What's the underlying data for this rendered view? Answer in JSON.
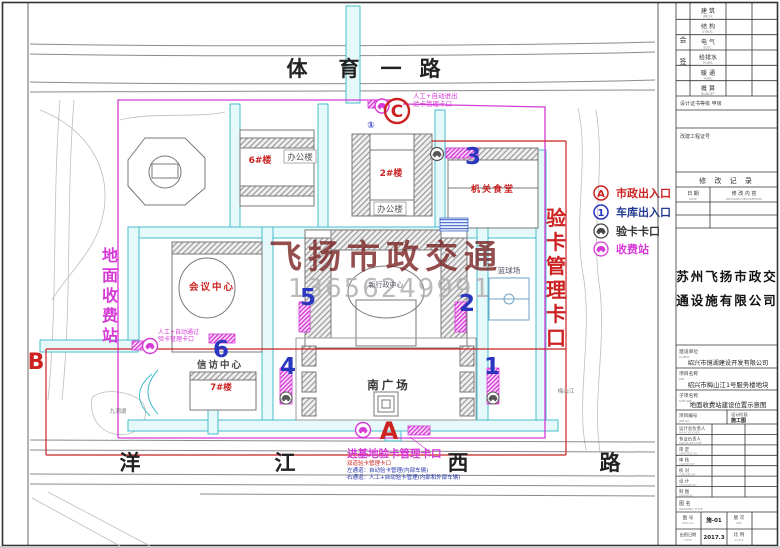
{
  "palette": {
    "red": "#cc2222",
    "blue": "#2a35c0",
    "magenta": "#d63ad6",
    "cyan": "#45bccc",
    "ink": "#333333"
  },
  "roads": {
    "top": [
      "体",
      "育",
      "一",
      "路"
    ],
    "bottom": [
      "洋",
      "江",
      "西",
      "路"
    ]
  },
  "legend": {
    "items": [
      {
        "symbol": "A",
        "label": "市政出入口",
        "color": "#cc2222"
      },
      {
        "symbol": "1",
        "label": "车库出入口",
        "color": "#223a8f"
      },
      {
        "symbol": "car-icon",
        "label": "验卡卡口",
        "color": "#333333"
      },
      {
        "symbol": "car-icon",
        "label": "收费站",
        "color": "#d63ad6"
      }
    ]
  },
  "markers": {
    "a": "A",
    "b": "B",
    "c": "C",
    "c_sub": "①",
    "garage": [
      "1",
      "2",
      "3",
      "4",
      "5",
      "6"
    ]
  },
  "vlabels": {
    "right": [
      "验",
      "卡",
      "管",
      "理",
      "卡",
      "口"
    ],
    "left": [
      "地",
      "面",
      "收",
      "费",
      "站"
    ]
  },
  "gates": {
    "north": {
      "line1": "人工+自动进出",
      "line2": "验卡管理卡口"
    },
    "west": {
      "line1": "人工+自动通过",
      "line2": "验卡管理卡口"
    },
    "south": {
      "title": "进基地验卡管理卡口",
      "sub1": "双道验卡管理卡口",
      "sub2": "左通道：自动验卡管理(内部车辆)",
      "sub3": "右通道：人工+自动验卡管理(内部和外部车辆)"
    }
  },
  "buildings": {
    "b6": "6#楼",
    "office1": "办公楼",
    "b2": "2#楼",
    "office2": "办公楼",
    "canteen": "机关食堂",
    "court": "篮球场",
    "admin": "新行政中心",
    "conference": "会议中心",
    "petition": "信访中心",
    "b7": "7#楼",
    "plaza": "南广场",
    "river": "梅山江",
    "pond": "九洞湖"
  },
  "watermark": {
    "company": "飞扬市政交通",
    "phone": "13656249991"
  },
  "tb": {
    "huiqian": [
      "会",
      "签"
    ],
    "disciplines": [
      {
        "cn": "建 筑",
        "en": "ARCH."
      },
      {
        "cn": "结 构",
        "en": "STRUC."
      },
      {
        "cn": "电 气",
        "en": "ELEC."
      },
      {
        "cn": "给排水",
        "en": "PLUM."
      },
      {
        "cn": "暖 通",
        "en": "HVAC"
      },
      {
        "cn": "概 算",
        "en": "BUDGET"
      }
    ],
    "cert": "设计证书等级  甲级",
    "seal": "改建工程证号",
    "rev": {
      "title": "修 改 记 录",
      "date_cn": "日 期",
      "date_en": "DATE",
      "desc_cn": "修 改 内 容",
      "desc_en": "REVISION DESCRIPTION"
    },
    "company1": "苏州飞扬市政交",
    "company2": "通设施有限公司",
    "client": {
      "label": "建设单位",
      "en": "CLIENT",
      "value": "绍兴市镜湖建设开发有限公司"
    },
    "job": {
      "label": "项目名称",
      "en": "JOB",
      "value": "绍兴市梅山江1号服务楼地块"
    },
    "subjob": {
      "label": "子项名称",
      "en": "SUB JOB",
      "value": "地面收费站建设位置示意图"
    },
    "jobno": {
      "label": "项目编号",
      "en": "JOB No."
    },
    "stage": {
      "label": "设计阶段",
      "value": "施工图"
    },
    "signs": [
      {
        "cn": "设计总负责人",
        "en": "MAIN DESIGNER"
      },
      {
        "cn": "专业负责人",
        "en": "DISCIPLINE CHIEF"
      },
      {
        "cn": "审 定",
        "en": "APPROVED BY"
      },
      {
        "cn": "审 核",
        "en": "AUDITED BY"
      },
      {
        "cn": "校 对",
        "en": "CHECKED BY"
      },
      {
        "cn": "设 计",
        "en": "DESIGNED BY"
      },
      {
        "cn": "制 图",
        "en": "DRAWN BY"
      }
    ],
    "title_row": {
      "label": "图 名",
      "en": "DRAWING TITLE"
    },
    "bottom": {
      "dwg": {
        "label": "图 号",
        "en": "DWG No.",
        "value": "施-01"
      },
      "ver": {
        "label": "版 次",
        "en": "VER."
      },
      "date": {
        "label": "出图日期",
        "en": "DATE",
        "value": "2017.3"
      },
      "scale": {
        "label": "比 例",
        "en": "SCALE"
      }
    }
  }
}
